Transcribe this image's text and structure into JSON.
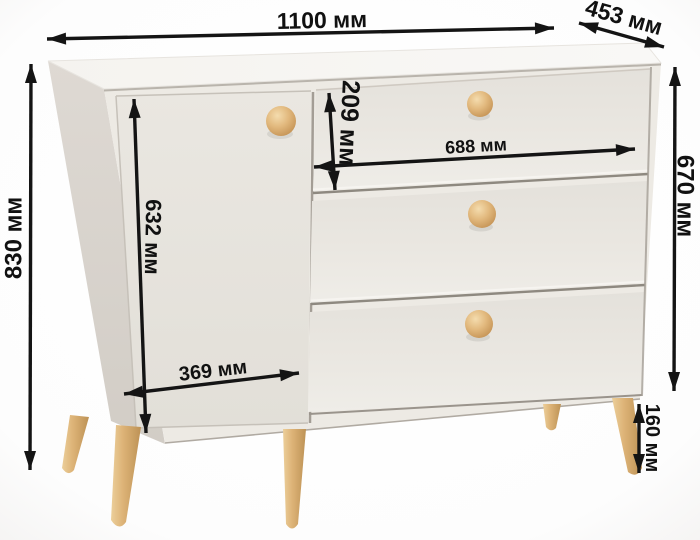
{
  "dimensions": {
    "width": {
      "label": "1100 мм"
    },
    "depth": {
      "label": "453 мм"
    },
    "height": {
      "label": "830 мм"
    },
    "body_height": {
      "label": "670 мм"
    },
    "door_height": {
      "label": "632 мм"
    },
    "door_width": {
      "label": "369 мм"
    },
    "top_drawer_height": {
      "label": "209 мм"
    },
    "drawer_width": {
      "label": "688 мм"
    },
    "leg_height": {
      "label": "160 мм"
    }
  },
  "colors": {
    "dimension_ink": "#141414",
    "cabinet_top": "#f7f5f2",
    "cabinet_side": "#d9d4ce",
    "cabinet_body": "#ebe8e2",
    "wood_knob": "#dcb277",
    "wood_leg": "#d9b175",
    "background": "#ffffff"
  }
}
